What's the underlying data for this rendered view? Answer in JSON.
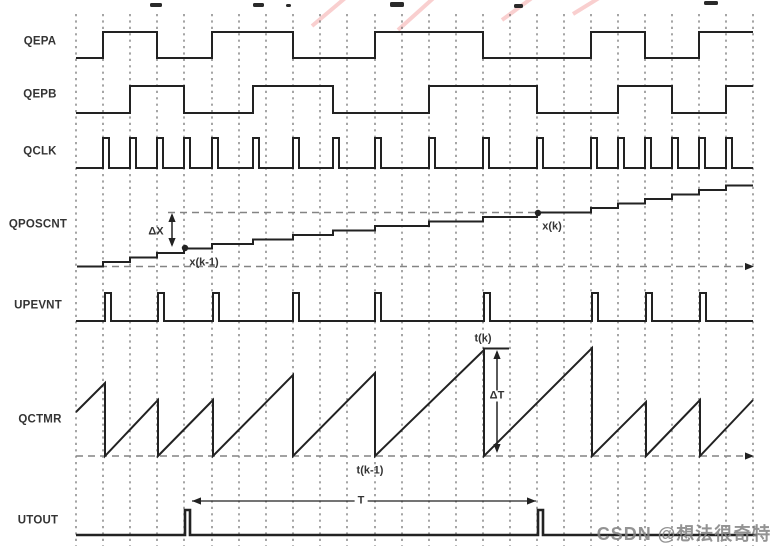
{
  "watermark": {
    "text": "CSDN @想法很奇特",
    "cx": 684,
    "cy": 533
  },
  "colors": {
    "signal_line": "#222222",
    "grid_line": "#5c5c5c",
    "ref_dash": "#848484",
    "label_text": "#333333",
    "watermark_text": "#848484",
    "pink_watermark": "#f5a8a8",
    "background": "#ffffff"
  },
  "diagram": {
    "title_fragments": [
      {
        "x": 150,
        "y": 3,
        "w": 12,
        "h": 4
      },
      {
        "x": 253,
        "y": 3,
        "w": 11,
        "h": 4
      },
      {
        "x": 286,
        "y": 4,
        "w": 5,
        "h": 3
      },
      {
        "x": 390,
        "y": 2,
        "w": 14,
        "h": 5
      },
      {
        "x": 514,
        "y": 4,
        "w": 9,
        "h": 4
      },
      {
        "x": 704,
        "y": 1,
        "w": 14,
        "h": 4
      }
    ],
    "pink_strokes": [
      {
        "x1": 312,
        "y1": 26,
        "x2": 350,
        "y2": -6
      },
      {
        "x1": 398,
        "y1": 30,
        "x2": 438,
        "y2": -6
      },
      {
        "x1": 502,
        "y1": 20,
        "x2": 540,
        "y2": -8
      },
      {
        "x1": 573,
        "y1": 14,
        "x2": 612,
        "y2": -10
      }
    ],
    "grid": {
      "y1": 14,
      "y2": 546,
      "xs": [
        76,
        103,
        130,
        157,
        184,
        212,
        239,
        266,
        293,
        320,
        347,
        375,
        402,
        429,
        456,
        483,
        510,
        537,
        564,
        591,
        618,
        645,
        672,
        699,
        726,
        753
      ]
    },
    "ref_lines": [
      {
        "x1": 168,
        "y": 212.5,
        "x2": 538,
        "arrow": false
      },
      {
        "x1": 100,
        "y": 266.5,
        "x2": 746,
        "arrow": true
      },
      {
        "x1": 76,
        "y": 456,
        "x2": 746,
        "arrow": true
      }
    ],
    "signals": [
      {
        "name": "QEPA",
        "kind": "digital",
        "label": {
          "cx": 40,
          "cy": 42
        },
        "x0": 76,
        "x1": 753,
        "lowY": 58,
        "highY": 32,
        "initial": "low",
        "edges": [
          103,
          157,
          212,
          293,
          375,
          483,
          591,
          645,
          699
        ]
      },
      {
        "name": "QEPB",
        "kind": "digital",
        "label": {
          "cx": 40,
          "cy": 95
        },
        "x0": 76,
        "x1": 753,
        "lowY": 113,
        "highY": 86,
        "initial": "low",
        "edges": [
          130,
          184,
          253,
          333,
          429,
          537,
          618,
          672,
          726
        ]
      },
      {
        "name": "QCLK",
        "kind": "pulses",
        "label": {
          "cx": 40,
          "cy": 152
        },
        "x0": 76,
        "x1": 753,
        "baseY": 168,
        "topY": 138,
        "pulseW": 6,
        "pulses": [
          103,
          130,
          157,
          184,
          212,
          253,
          293,
          333,
          375,
          429,
          483,
          537,
          591,
          618,
          645,
          672,
          699,
          726
        ]
      },
      {
        "name": "QPOSCNT",
        "kind": "staircase",
        "label": {
          "cx": 38,
          "cy": 225
        },
        "x0": 77,
        "x1": 753,
        "startLevel": 266.5,
        "stepH": 4.5,
        "steps": [
          103,
          130,
          157,
          184,
          212,
          253,
          293,
          333,
          375,
          429,
          483,
          537,
          591,
          618,
          645,
          672,
          699,
          726
        ]
      },
      {
        "name": "UPEVNT",
        "kind": "pulses",
        "label": {
          "cx": 38,
          "cy": 306
        },
        "x0": 76,
        "x1": 753,
        "baseY": 321,
        "topY": 293,
        "pulseW": 6,
        "pulses": [
          105,
          158,
          213,
          293,
          375,
          484,
          592,
          646,
          700
        ]
      },
      {
        "name": "QCTMR",
        "kind": "sawtooth",
        "label": {
          "cx": 40,
          "cy": 420
        },
        "startX": 76,
        "startY": 412,
        "baseY": 456,
        "endX": 753,
        "endY": 400,
        "resets": [
          {
            "x": 105,
            "peakY": 383
          },
          {
            "x": 158,
            "peakY": 400
          },
          {
            "x": 213,
            "peakY": 400
          },
          {
            "x": 293,
            "peakY": 375
          },
          {
            "x": 375,
            "peakY": 373
          },
          {
            "x": 484,
            "peakY": 350
          },
          {
            "x": 592,
            "peakY": 348
          },
          {
            "x": 646,
            "peakY": 402
          },
          {
            "x": 700,
            "peakY": 400
          }
        ]
      },
      {
        "name": "UTOUT",
        "kind": "pulses",
        "label": {
          "cx": 38,
          "cy": 521
        },
        "x0": 76,
        "x1": 757,
        "baseY": 535,
        "topY": 510,
        "pulseW": 5,
        "thick": true,
        "pulses": [
          185,
          538
        ]
      }
    ],
    "measure_arrows": [
      {
        "kind": "v",
        "x": 172,
        "y1": 213,
        "y2": 247
      },
      {
        "kind": "v",
        "x": 497,
        "y1": 350,
        "y2": 453
      },
      {
        "kind": "h",
        "y": 501,
        "x1": 192,
        "x2": 536
      }
    ],
    "ticks": [
      {
        "x1": 483,
        "y1": 348.5,
        "x2": 509,
        "y2": 348.5
      }
    ],
    "dots": [
      {
        "x": 185,
        "y": 248
      },
      {
        "x": 538,
        "y": 213
      }
    ],
    "labels": {
      "dx": {
        "text": "ΔX",
        "cx": 156,
        "cy": 232
      },
      "xk1": {
        "text": "x(k-1)",
        "cx": 204,
        "cy": 263
      },
      "xk": {
        "text": "x(k)",
        "cx": 552,
        "cy": 227
      },
      "tk": {
        "text": "t(k)",
        "cx": 483,
        "cy": 339
      },
      "dt": {
        "text": "ΔT",
        "cx": 497,
        "cy": 396,
        "bg": true
      },
      "tk1": {
        "text": "t(k-1)",
        "cx": 370,
        "cy": 471
      },
      "t": {
        "text": "T",
        "cx": 361,
        "cy": 501,
        "bg": true
      }
    }
  }
}
